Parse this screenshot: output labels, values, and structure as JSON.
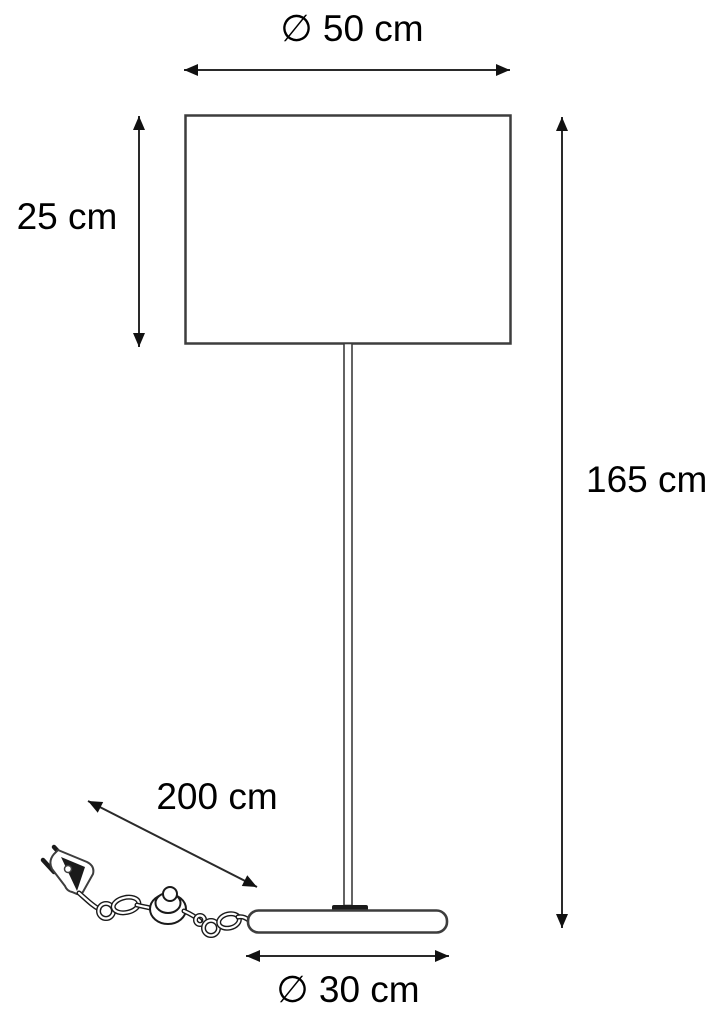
{
  "diagram": {
    "labels": {
      "shade_diameter": "∅ 50 cm",
      "shade_height": "25 cm",
      "lamp_height": "165 cm",
      "cable_length": "200 cm",
      "base_diameter": "∅ 30 cm"
    },
    "colors": {
      "line": "#1a1a1a",
      "text": "#000000",
      "background": "#ffffff"
    }
  }
}
